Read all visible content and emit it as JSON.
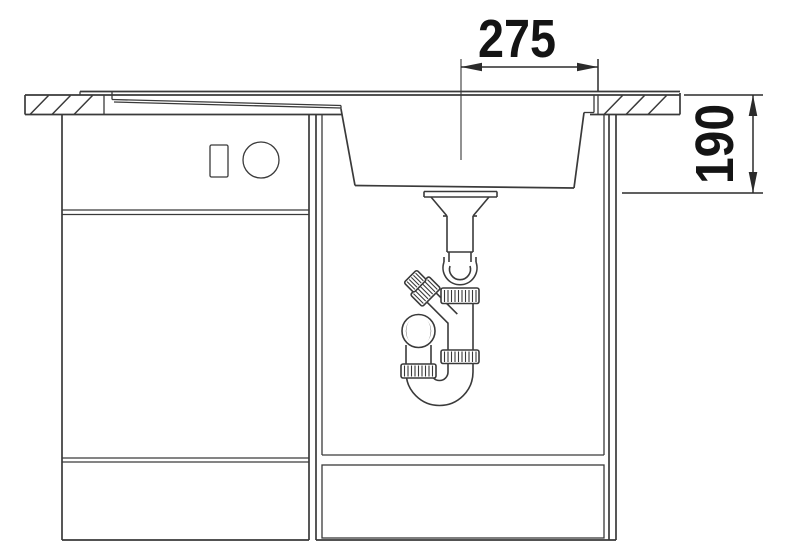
{
  "drawing": {
    "dimensions": {
      "bowl_center_to_right_edge": {
        "value": "275",
        "orientation": "horizontal"
      },
      "bowl_depth": {
        "value": "190",
        "orientation": "vertical"
      }
    },
    "colors": {
      "line": "#3a3a3a",
      "dimension_text": "#141414",
      "background": "#ffffff"
    }
  }
}
